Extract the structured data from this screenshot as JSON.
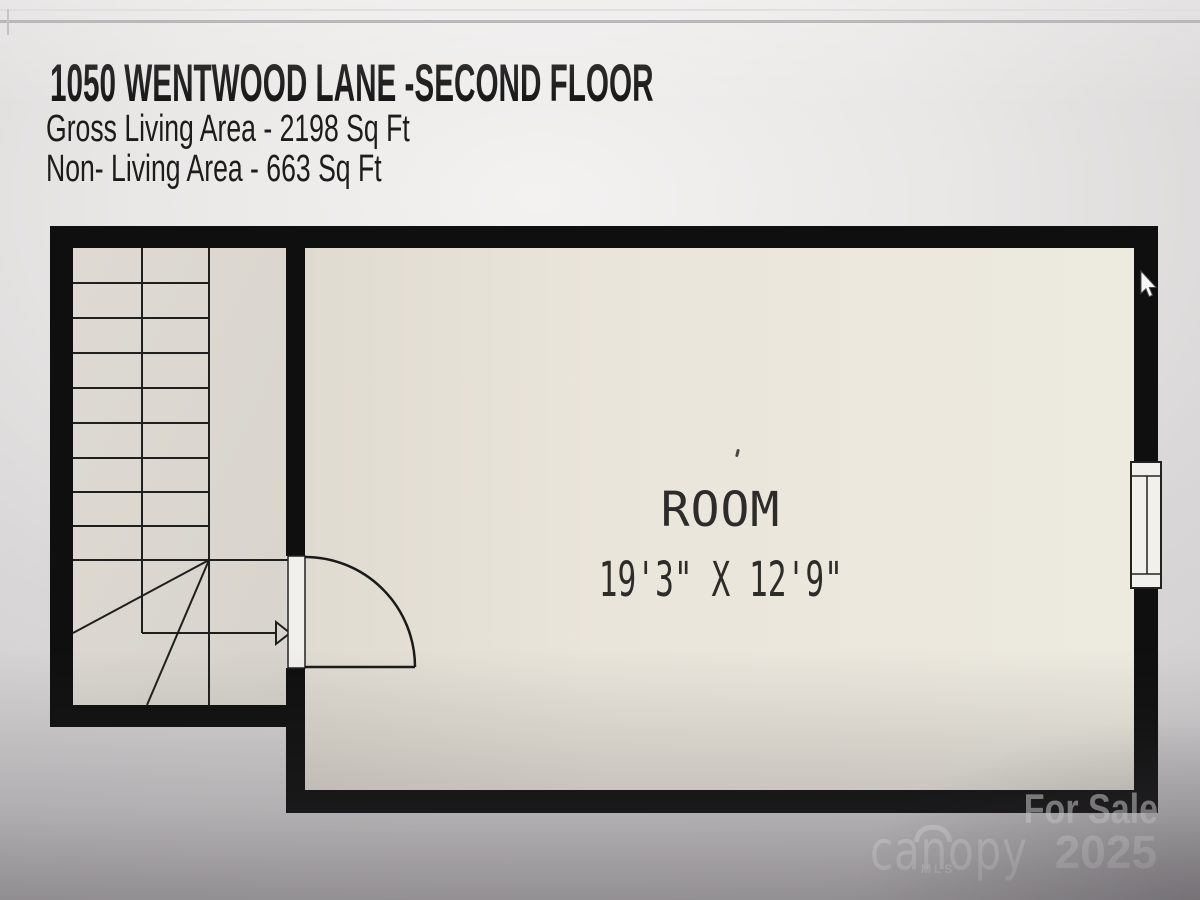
{
  "header": {
    "title": "1050 WENTWOOD LANE -SECOND FLOOR",
    "lines": [
      "Gross Living Area - 2198 Sq Ft",
      "Non- Living Area - 663 Sq Ft"
    ]
  },
  "plan": {
    "room_label": "ROOM",
    "room_dimensions": "19'3\" X 12'9\""
  },
  "watermark": {
    "for_sale": "For Sale",
    "brand": "canopy",
    "brand_subtext": "MLS",
    "year": "2025"
  },
  "colors": {
    "wall": "#0f0f0f",
    "room_floor": "#eae6dc",
    "stair_floor": "#dcd8d1",
    "plan_line": "#1f1f1d",
    "door_window_fill": "#f2f0ec",
    "background": "#d6d4d5",
    "title_text": "#141414",
    "room_text": "#2e2c29",
    "watermark_text": "rgba(255,255,255,0.55)"
  }
}
